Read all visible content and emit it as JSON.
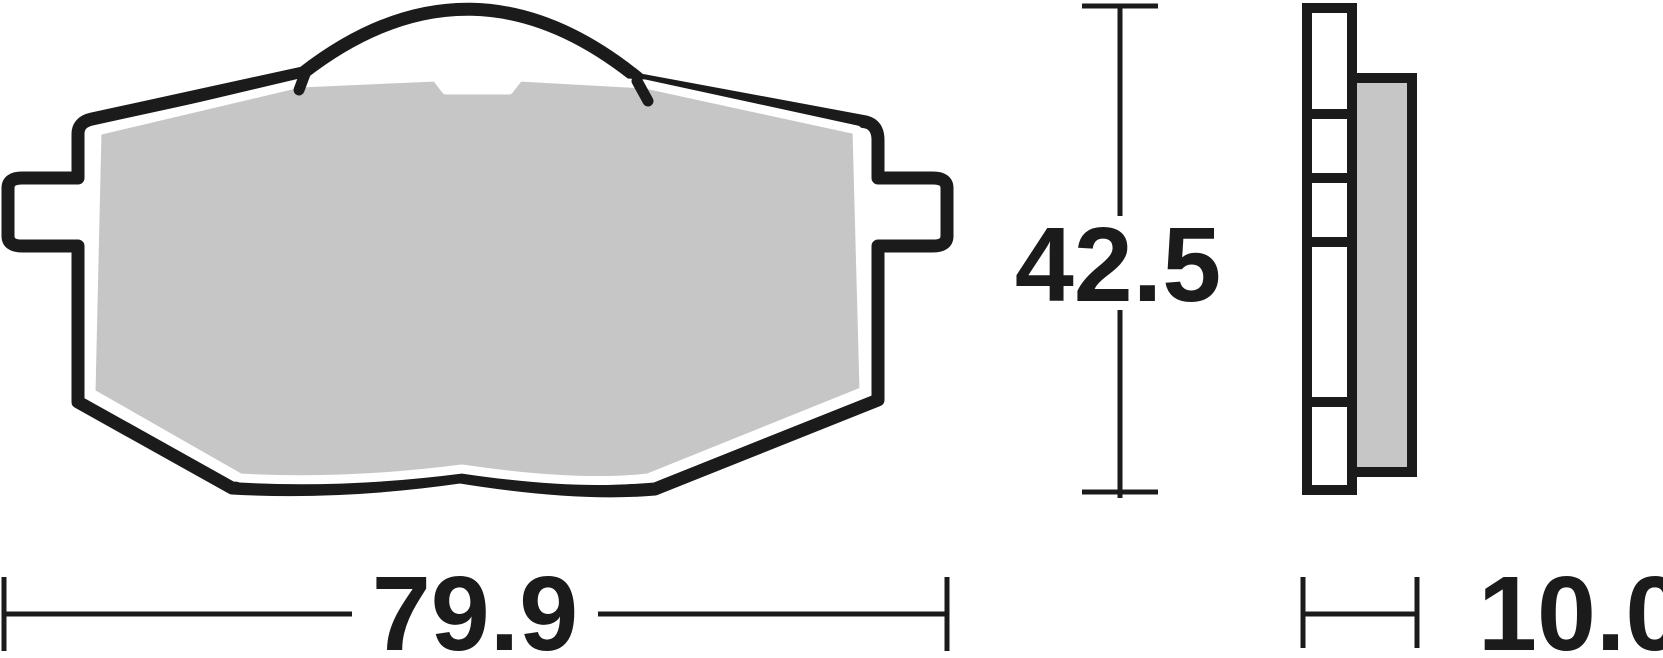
{
  "drawing": {
    "type": "technical-dimension-drawing",
    "subject": "brake pad",
    "dimensions": {
      "width": "79.9",
      "height": "42.5",
      "thickness": "10.0"
    },
    "colors": {
      "ink": "#1b1b1b",
      "friction_material": "#c6c6c6",
      "backing_plate": "#ffffff",
      "background": "#ffffff"
    },
    "views": {
      "front": "pad-face-with-spring-clip",
      "side": "pad-edge-profile"
    }
  }
}
